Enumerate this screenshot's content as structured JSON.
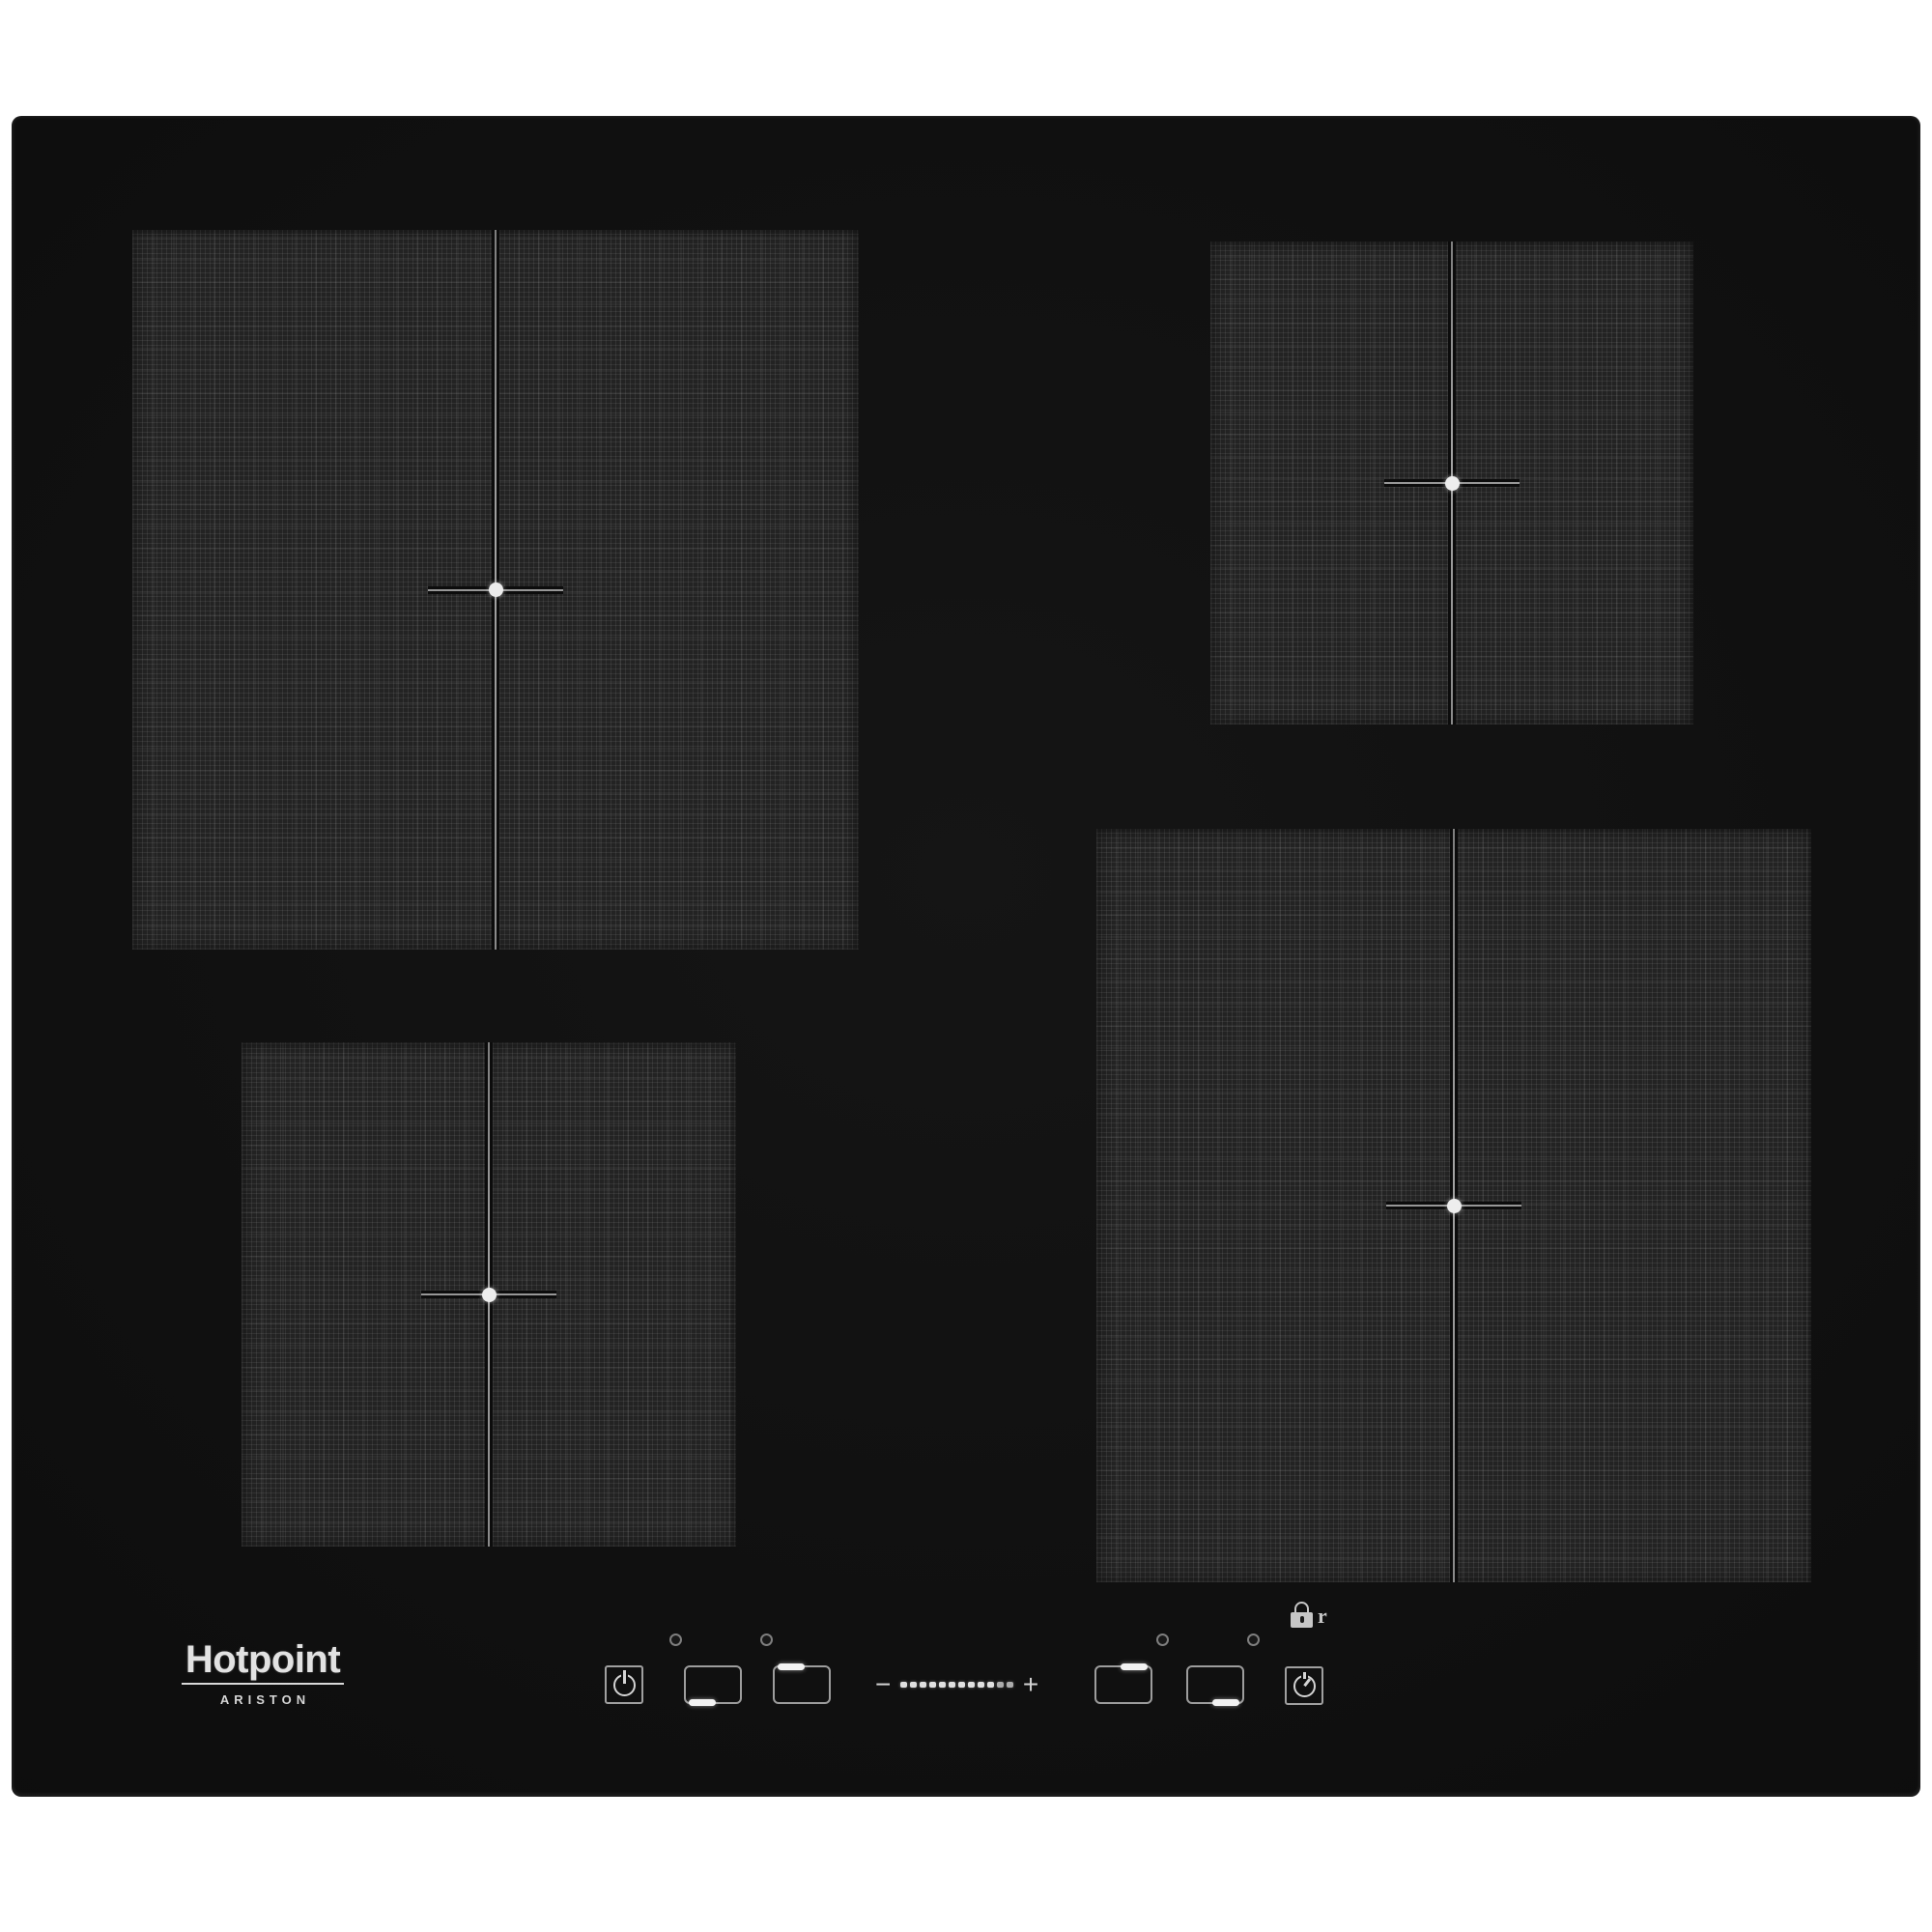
{
  "photo": {
    "background_color": "#ffffff",
    "hob_color": "#0e0e0e",
    "zone_texture_color": "#2b2b2b",
    "marker_line_color": "#979797",
    "marker_dot_color": "#ededed"
  },
  "brand": {
    "name": "Hotpoint",
    "subbrand": "ARISTON"
  },
  "zones": [
    {
      "id": "top-left",
      "size": "large",
      "marker": "center-cross",
      "divider": "vertical"
    },
    {
      "id": "top-right",
      "size": "small",
      "marker": "center-cross",
      "divider": "vertical"
    },
    {
      "id": "bottom-left",
      "size": "small",
      "marker": "center-cross",
      "divider": "vertical"
    },
    {
      "id": "bottom-right",
      "size": "large",
      "marker": "center-cross",
      "divider": "vertical"
    }
  ],
  "controls": {
    "power_button_icon": "power-icon",
    "timer_button_icon": "timer-clock-icon",
    "lock": {
      "icon": "lock-icon",
      "label": "r"
    },
    "led_count": 4,
    "zone_selectors": [
      {
        "icon": "zone-select-icon",
        "active_edge": "bottom-left"
      },
      {
        "icon": "zone-select-icon",
        "active_edge": "top-left"
      },
      {
        "icon": "zone-select-icon",
        "active_edge": "top-right"
      },
      {
        "icon": "zone-select-icon",
        "active_edge": "bottom-right"
      }
    ],
    "slider": {
      "minus": "−",
      "dot_count": 12,
      "plus": "+"
    },
    "icon_color": "#d4d4d4",
    "active_bar_color": "#f3f3f3"
  }
}
